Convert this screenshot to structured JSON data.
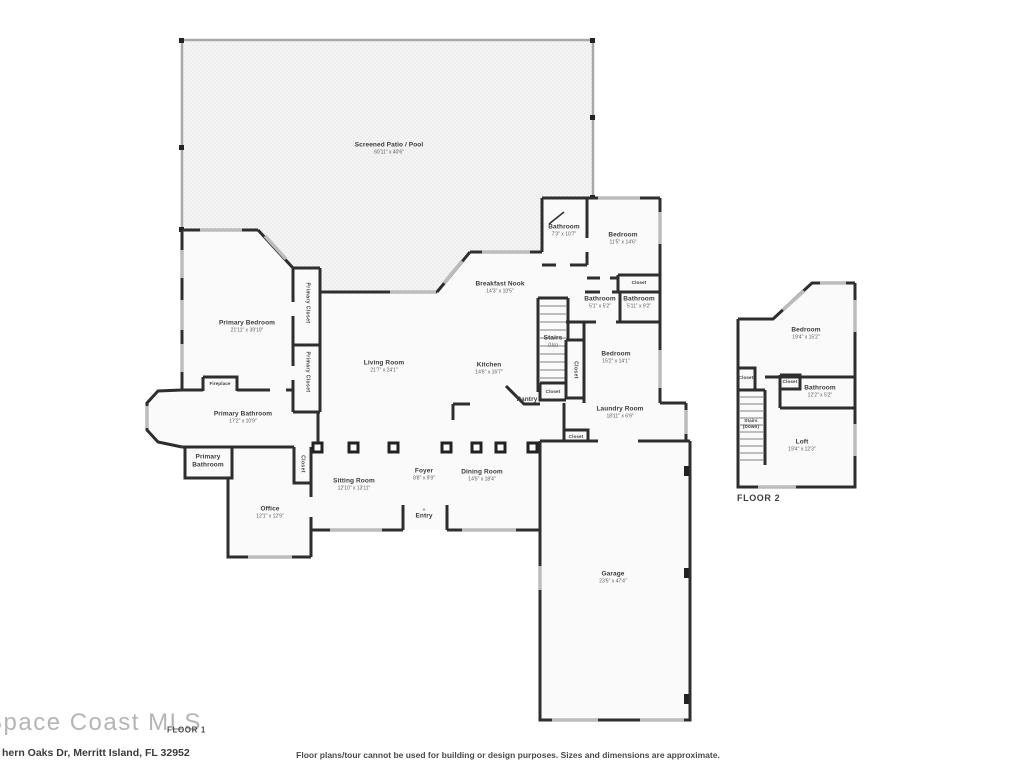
{
  "branding": {
    "logo": "Space Coast MLS",
    "address": "hern Oaks Dr, Merritt Island, FL 32952",
    "disclaimer": "Floor plans/tour cannot be used for building or design purposes. Sizes and dimensions are approximate.",
    "floor1_label": "FLOOR 1",
    "floor2_label": "FLOOR 2"
  },
  "colors": {
    "walls": "#2e2e2e",
    "windows": "#bcbcbc",
    "room_fill": "#fafafa",
    "patio_fill": "#f4f4f4",
    "text": "#3b3b3b"
  },
  "floor1": {
    "patio": {
      "name": "Screened Patio / Pool",
      "dims": "60'11\" x 40'6\""
    },
    "primary_bedroom": {
      "name": "Primary Bedroom",
      "dims": "21'11\" x 39'10\""
    },
    "primary_closet_1": {
      "name": "Primary Closet"
    },
    "primary_closet_2": {
      "name": "Primary Closet"
    },
    "living_room": {
      "name": "Living Room",
      "dims": "21'7\" x 24'1\""
    },
    "breakfast_nook": {
      "name": "Breakfast Nook",
      "dims": "14'3\" x 10'5\""
    },
    "kitchen": {
      "name": "Kitchen",
      "dims": "14'6\" x 16'7\""
    },
    "bathroom_guest": {
      "name": "Bathroom",
      "dims": "7'3\" x 10'7\""
    },
    "bedroom_guest": {
      "name": "Bedroom",
      "dims": "11'5\" x 14'6\""
    },
    "closet_guest": {
      "name": "Closet"
    },
    "bathroom_small": {
      "name": "Bathroom",
      "dims": "5'1\" x 5'2\""
    },
    "bathroom_hall": {
      "name": "Bathroom",
      "dims": "5'11\" x 9'2\""
    },
    "stairs": {
      "name": "Stairs",
      "line2": "(Up)"
    },
    "closet_stairs": {
      "name": "Closet"
    },
    "closet_understairs": {
      "name": "Closet"
    },
    "pantry": {
      "name": "Pantry"
    },
    "bedroom_mid": {
      "name": "Bedroom",
      "dims": "15'2\" x 14'1\""
    },
    "laundry": {
      "name": "Laundry Room",
      "dims": "18'11\" x 6'9\""
    },
    "closet_laundry": {
      "name": "Closet"
    },
    "fireplace": {
      "name": "Fireplace"
    },
    "primary_bathroom": {
      "name": "Primary Bathroom",
      "dims": "17'2\" x 10'9\""
    },
    "primary_bathroom_2": {
      "name": "Primary",
      "line2": "Bathroom"
    },
    "closet_hall": {
      "name": "Closet"
    },
    "office": {
      "name": "Office",
      "dims": "12'1\" x 12'9\""
    },
    "sitting_room": {
      "name": "Sitting Room",
      "dims": "12'10\" x 13'11\""
    },
    "foyer": {
      "name": "Foyer",
      "dims": "8'8\" x 9'9\""
    },
    "entry": {
      "name": "Entry"
    },
    "dining_room": {
      "name": "Dining Room",
      "dims": "14'5\" x 18'4\""
    },
    "garage": {
      "name": "Garage",
      "dims": "23'5\" x 47'4\""
    }
  },
  "floor2": {
    "bedroom": {
      "name": "Bedroom",
      "dims": "19'4\" x 15'2\""
    },
    "closet_left": {
      "name": "Closet"
    },
    "closet_mid": {
      "name": "Closet"
    },
    "bathroom": {
      "name": "Bathroom",
      "dims": "12'2\" x 5'2\""
    },
    "stairs": {
      "name": "Stairs",
      "line2": "(Down)"
    },
    "loft": {
      "name": "Loft",
      "dims": "19'4\" x 12'3\""
    }
  }
}
